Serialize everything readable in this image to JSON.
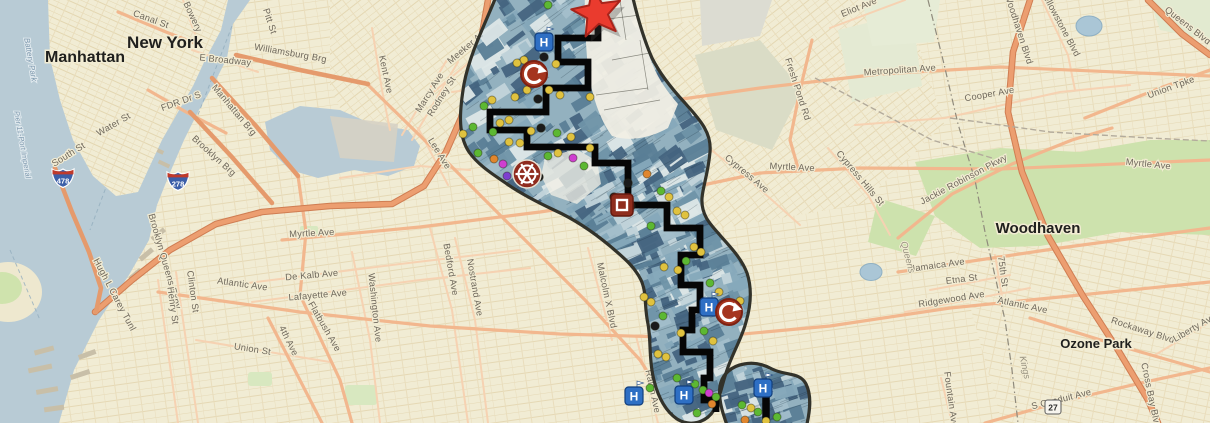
{
  "map": {
    "description": "GIS corridor study map over Brooklyn/Queens NYC basemap",
    "colors": {
      "land": "#f1ecd4",
      "water": "#b8cbd5",
      "route": "#060606",
      "corridor_outline": "#32322a",
      "corridor_base": "#93b1bf",
      "highway_core": "#ec9e70",
      "highway_casing": "#cf7d52",
      "arterial": "#f2b78e",
      "minor_road": "#f6d2b2",
      "marker_palette": {
        "yellow": "#e0c23f",
        "green": "#5cb832",
        "black": "#1a1a1a",
        "orange": "#e0862e",
        "magenta": "#cf3fd0",
        "purple": "#7d3fd0"
      },
      "mosaic": [
        "#44647f",
        "#5a7e96",
        "#6f93a8",
        "#86a9ba",
        "#a3bfcb",
        "#c2d4da",
        "#dde7e7",
        "#44647f",
        "#5a7e96",
        "#86a9ba"
      ]
    },
    "labels": {
      "city": [
        {
          "t": "New York",
          "x": 165,
          "y": 48,
          "r": 0,
          "s": 17
        },
        {
          "t": "Manhattan",
          "x": 85,
          "y": 62,
          "r": 0,
          "s": 16
        },
        {
          "t": "Woodhaven",
          "x": 1038,
          "y": 233,
          "r": 0,
          "s": 15
        },
        {
          "t": "Ozone Park",
          "x": 1096,
          "y": 348,
          "r": 0,
          "s": 13
        }
      ],
      "street": [
        {
          "t": "Canal St",
          "x": 150,
          "y": 22,
          "r": 20
        },
        {
          "t": "Bowery",
          "x": 190,
          "y": 18,
          "r": 65
        },
        {
          "t": "Pitt St",
          "x": 267,
          "y": 22,
          "r": 72
        },
        {
          "t": "E Broadway",
          "x": 225,
          "y": 63,
          "r": 6
        },
        {
          "t": "Williamsburg Brg",
          "x": 290,
          "y": 56,
          "r": 10
        },
        {
          "t": "FDR Dr S",
          "x": 182,
          "y": 104,
          "r": -20
        },
        {
          "t": "Manhattan Brg",
          "x": 232,
          "y": 112,
          "r": 50
        },
        {
          "t": "Brooklyn Brg",
          "x": 212,
          "y": 158,
          "r": 42
        },
        {
          "t": "Water St",
          "x": 115,
          "y": 127,
          "r": -30
        },
        {
          "t": "South St",
          "x": 70,
          "y": 157,
          "r": -32
        },
        {
          "t": "Hugh L Carey Tunl",
          "x": 112,
          "y": 296,
          "r": 62
        },
        {
          "t": "Brooklyn Queens Expy",
          "x": 162,
          "y": 262,
          "r": 74
        },
        {
          "t": "Henry St",
          "x": 170,
          "y": 306,
          "r": 82
        },
        {
          "t": "Clinton St",
          "x": 190,
          "y": 292,
          "r": 82
        },
        {
          "t": "Atlantic Ave",
          "x": 242,
          "y": 287,
          "r": 8
        },
        {
          "t": "Union St",
          "x": 252,
          "y": 352,
          "r": 9
        },
        {
          "t": "4th Ave",
          "x": 286,
          "y": 342,
          "r": 64
        },
        {
          "t": "Flatbush Ave",
          "x": 322,
          "y": 328,
          "r": 60
        },
        {
          "t": "Myrtle Ave",
          "x": 312,
          "y": 236,
          "r": -3
        },
        {
          "t": "De Kalb Ave",
          "x": 312,
          "y": 278,
          "r": -5
        },
        {
          "t": "Lafayette Ave",
          "x": 318,
          "y": 298,
          "r": -5
        },
        {
          "t": "Washington Ave",
          "x": 372,
          "y": 308,
          "r": 84
        },
        {
          "t": "Bedford Ave",
          "x": 448,
          "y": 270,
          "r": 80
        },
        {
          "t": "Nostrand Ave",
          "x": 472,
          "y": 288,
          "r": 80
        },
        {
          "t": "Kent Ave",
          "x": 383,
          "y": 75,
          "r": 78
        },
        {
          "t": "Marcy Ave",
          "x": 432,
          "y": 94,
          "r": -58
        },
        {
          "t": "Rodney St",
          "x": 444,
          "y": 98,
          "r": -58
        },
        {
          "t": "Meeker Ave",
          "x": 470,
          "y": 48,
          "r": -40
        },
        {
          "t": "Grand St",
          "x": 487,
          "y": 80,
          "r": -5
        },
        {
          "t": "Humboldt St",
          "x": 512,
          "y": 42,
          "r": 82
        },
        {
          "t": "Lee Ave",
          "x": 437,
          "y": 155,
          "r": 58
        },
        {
          "t": "Broadway",
          "x": 592,
          "y": 226,
          "r": 42
        },
        {
          "t": "Malcolm X Blvd",
          "x": 604,
          "y": 296,
          "r": 78
        },
        {
          "t": "Ralph Ave",
          "x": 650,
          "y": 392,
          "r": 78
        },
        {
          "t": "Metropolitan Ave",
          "x": 900,
          "y": 73,
          "r": -4
        },
        {
          "t": "Eliot Ave",
          "x": 860,
          "y": 10,
          "r": -22
        },
        {
          "t": "Fresh Pond Rd",
          "x": 795,
          "y": 90,
          "r": 72
        },
        {
          "t": "Myrtle Ave",
          "x": 792,
          "y": 170,
          "r": 3
        },
        {
          "t": "Cypress Ave",
          "x": 745,
          "y": 176,
          "r": 40
        },
        {
          "t": "Cypress Hills St",
          "x": 858,
          "y": 180,
          "r": 50
        },
        {
          "t": "Cooper Ave",
          "x": 990,
          "y": 97,
          "r": -10
        },
        {
          "t": "Woodhaven Blvd",
          "x": 1016,
          "y": 30,
          "r": 72
        },
        {
          "t": "Yellowstone Blvd",
          "x": 1058,
          "y": 25,
          "r": 62
        },
        {
          "t": "Queens Blvd",
          "x": 1186,
          "y": 28,
          "r": 38
        },
        {
          "t": "Union Tpke",
          "x": 1172,
          "y": 90,
          "r": -20
        },
        {
          "t": "Myrtle Ave",
          "x": 1148,
          "y": 167,
          "r": 6
        },
        {
          "t": "Jackie Robinson Pkwy",
          "x": 965,
          "y": 182,
          "r": -28
        },
        {
          "t": "Jamaica Ave",
          "x": 938,
          "y": 268,
          "r": -8
        },
        {
          "t": "Etna St",
          "x": 962,
          "y": 282,
          "r": -7
        },
        {
          "t": "Ridgewood Ave",
          "x": 952,
          "y": 302,
          "r": -9
        },
        {
          "t": "Atlantic Ave",
          "x": 1022,
          "y": 308,
          "r": 12
        },
        {
          "t": "Rockaway Blvd",
          "x": 1142,
          "y": 333,
          "r": 18
        },
        {
          "t": "Liberty Ave",
          "x": 1196,
          "y": 330,
          "r": -30
        },
        {
          "t": "S Conduit Ave",
          "x": 1062,
          "y": 402,
          "r": -14
        },
        {
          "t": "Cross Bay Blvd",
          "x": 1148,
          "y": 396,
          "r": 78
        },
        {
          "t": "75th St",
          "x": 1000,
          "y": 272,
          "r": 82
        },
        {
          "t": "Fountain Ave",
          "x": 948,
          "y": 400,
          "r": 82
        }
      ],
      "water": [
        {
          "t": "Battery Park",
          "x": 28,
          "y": 60,
          "r": 80,
          "s": 8
        },
        {
          "t": "Pier 11-Port Imperial",
          "x": 20,
          "y": 145,
          "r": 80,
          "s": 7.5
        }
      ],
      "county": [
        {
          "t": "Queens",
          "x": 905,
          "y": 258,
          "r": 75
        },
        {
          "t": "Kings",
          "x": 1022,
          "y": 368,
          "r": 78
        }
      ]
    },
    "shields": {
      "interstate": [
        {
          "num": "478",
          "x": 63,
          "y": 178
        },
        {
          "num": "278",
          "x": 178,
          "y": 181
        }
      ],
      "state": [
        {
          "num": "27",
          "x": 1053,
          "y": 407
        }
      ]
    },
    "corridor": {
      "route": [
        [
          598,
          22
        ],
        [
          598,
          38
        ],
        [
          558,
          38
        ],
        [
          558,
          62
        ],
        [
          588,
          62
        ],
        [
          588,
          88
        ],
        [
          546,
          88
        ],
        [
          546,
          112
        ],
        [
          490,
          112
        ],
        [
          490,
          130
        ],
        [
          527,
          130
        ],
        [
          527,
          147
        ],
        [
          595,
          147
        ],
        [
          595,
          163
        ],
        [
          628,
          163
        ],
        [
          628,
          205
        ],
        [
          667,
          205
        ],
        [
          667,
          228
        ],
        [
          700,
          228
        ],
        [
          700,
          255
        ],
        [
          681,
          255
        ],
        [
          681,
          285
        ],
        [
          700,
          285
        ],
        [
          700,
          310
        ],
        [
          692,
          310
        ],
        [
          692,
          330
        ],
        [
          683,
          330
        ],
        [
          683,
          352
        ],
        [
          710,
          352
        ],
        [
          710,
          378
        ],
        [
          704,
          378
        ],
        [
          704,
          400
        ],
        [
          716,
          400
        ],
        [
          716,
          412
        ]
      ],
      "route2": [
        [
          766,
          390
        ],
        [
          766,
          426
        ]
      ],
      "star": {
        "x": 597,
        "y": 13
      },
      "hospital_letter": "H",
      "hospitals": [
        {
          "x": 544,
          "y": 42
        },
        {
          "x": 709,
          "y": 307
        },
        {
          "x": 634,
          "y": 396
        },
        {
          "x": 684,
          "y": 395
        },
        {
          "x": 763,
          "y": 388
        }
      ],
      "transfer_icons": [
        {
          "x": 534,
          "y": 74
        },
        {
          "x": 729,
          "y": 312
        }
      ],
      "wheel_icons": [
        {
          "x": 527,
          "y": 174
        }
      ],
      "square_icons": [
        {
          "x": 622,
          "y": 205
        }
      ],
      "markers": [
        [
          548,
          5,
          "green"
        ],
        [
          524,
          60,
          "yellow"
        ],
        [
          556,
          64,
          "yellow"
        ],
        [
          544,
          57,
          "black"
        ],
        [
          517,
          63,
          "yellow"
        ],
        [
          527,
          90,
          "yellow"
        ],
        [
          549,
          90,
          "yellow"
        ],
        [
          538,
          99,
          "black"
        ],
        [
          560,
          95,
          "yellow"
        ],
        [
          590,
          97,
          "yellow"
        ],
        [
          515,
          97,
          "yellow"
        ],
        [
          492,
          100,
          "yellow"
        ],
        [
          484,
          106,
          "green"
        ],
        [
          473,
          127,
          "green"
        ],
        [
          463,
          134,
          "yellow"
        ],
        [
          500,
          123,
          "yellow"
        ],
        [
          509,
          120,
          "yellow"
        ],
        [
          520,
          143,
          "yellow"
        ],
        [
          509,
          142,
          "yellow"
        ],
        [
          531,
          131,
          "yellow"
        ],
        [
          541,
          128,
          "black"
        ],
        [
          493,
          132,
          "green"
        ],
        [
          478,
          153,
          "green"
        ],
        [
          494,
          159,
          "orange"
        ],
        [
          503,
          164,
          "magenta"
        ],
        [
          507,
          176,
          "purple"
        ],
        [
          533,
          170,
          "black"
        ],
        [
          539,
          177,
          "black"
        ],
        [
          548,
          156,
          "green"
        ],
        [
          558,
          153,
          "yellow"
        ],
        [
          573,
          158,
          "magenta"
        ],
        [
          584,
          166,
          "green"
        ],
        [
          557,
          133,
          "green"
        ],
        [
          571,
          137,
          "yellow"
        ],
        [
          590,
          148,
          "yellow"
        ],
        [
          614,
          197,
          "black"
        ],
        [
          631,
          206,
          "black"
        ],
        [
          628,
          183,
          "black"
        ],
        [
          647,
          174,
          "orange"
        ],
        [
          661,
          191,
          "green"
        ],
        [
          669,
          197,
          "yellow"
        ],
        [
          677,
          211,
          "yellow"
        ],
        [
          685,
          215,
          "yellow"
        ],
        [
          651,
          226,
          "green"
        ],
        [
          694,
          247,
          "yellow"
        ],
        [
          701,
          252,
          "yellow"
        ],
        [
          686,
          261,
          "green"
        ],
        [
          664,
          267,
          "yellow"
        ],
        [
          678,
          270,
          "yellow"
        ],
        [
          710,
          283,
          "green"
        ],
        [
          719,
          292,
          "yellow"
        ],
        [
          740,
          301,
          "yellow"
        ],
        [
          644,
          297,
          "yellow"
        ],
        [
          651,
          302,
          "yellow"
        ],
        [
          663,
          316,
          "green"
        ],
        [
          655,
          326,
          "black"
        ],
        [
          681,
          333,
          "yellow"
        ],
        [
          704,
          331,
          "green"
        ],
        [
          713,
          341,
          "yellow"
        ],
        [
          658,
          354,
          "yellow"
        ],
        [
          666,
          357,
          "yellow"
        ],
        [
          677,
          378,
          "green"
        ],
        [
          695,
          384,
          "green"
        ],
        [
          703,
          390,
          "green"
        ],
        [
          709,
          393,
          "magenta"
        ],
        [
          716,
          397,
          "green"
        ],
        [
          712,
          404,
          "orange"
        ],
        [
          697,
          413,
          "green"
        ],
        [
          650,
          388,
          "green"
        ],
        [
          742,
          405,
          "green"
        ],
        [
          751,
          408,
          "yellow"
        ],
        [
          758,
          412,
          "green"
        ],
        [
          777,
          417,
          "green"
        ],
        [
          766,
          421,
          "yellow"
        ],
        [
          745,
          420,
          "orange"
        ]
      ]
    }
  }
}
